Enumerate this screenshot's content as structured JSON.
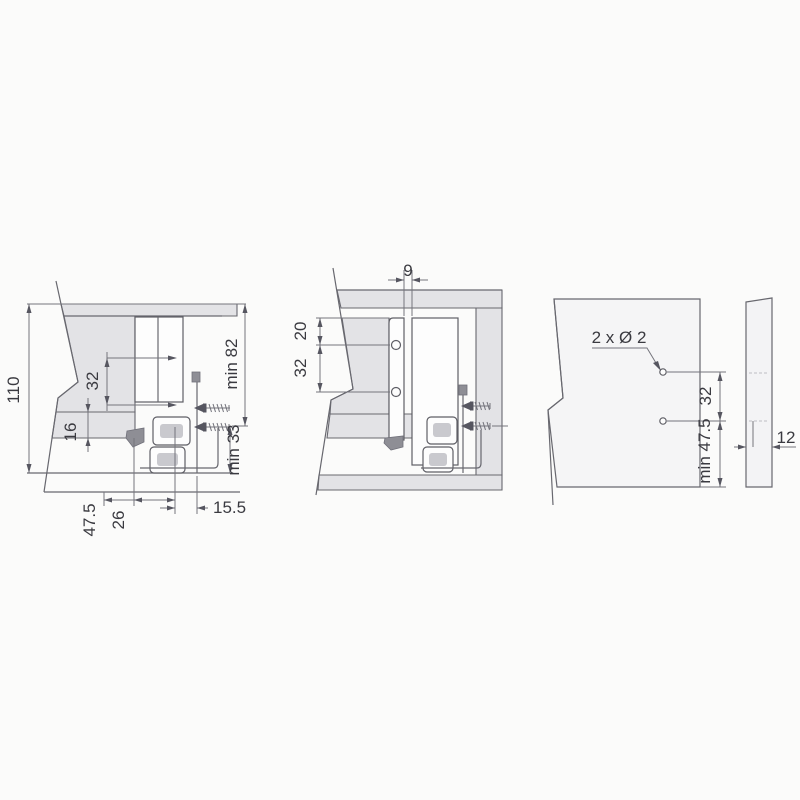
{
  "page": {
    "background": "#fbfbfa",
    "line_color": "#68686f",
    "text_color": "#3a3a40",
    "panel_fill": "#e3e3e6"
  },
  "diagrams": {
    "back_section": {
      "dims": {
        "height_110": "110",
        "hole_spacing_32": "32",
        "bottom_16": "16",
        "back_47_5": "47.5",
        "back_26": "26",
        "side_15_5": "15.5",
        "min_82": "min 82",
        "min_33": "min 33"
      }
    },
    "front_section": {
      "dims": {
        "gap_9": "9",
        "top_20": "20",
        "hole_spacing_32": "32"
      }
    },
    "back_panel": {
      "dims": {
        "holes_label": "2 x Ø 2",
        "hole_spacing_32": "32",
        "min_47_5": "min 47.5",
        "thickness_12": "12"
      }
    }
  }
}
